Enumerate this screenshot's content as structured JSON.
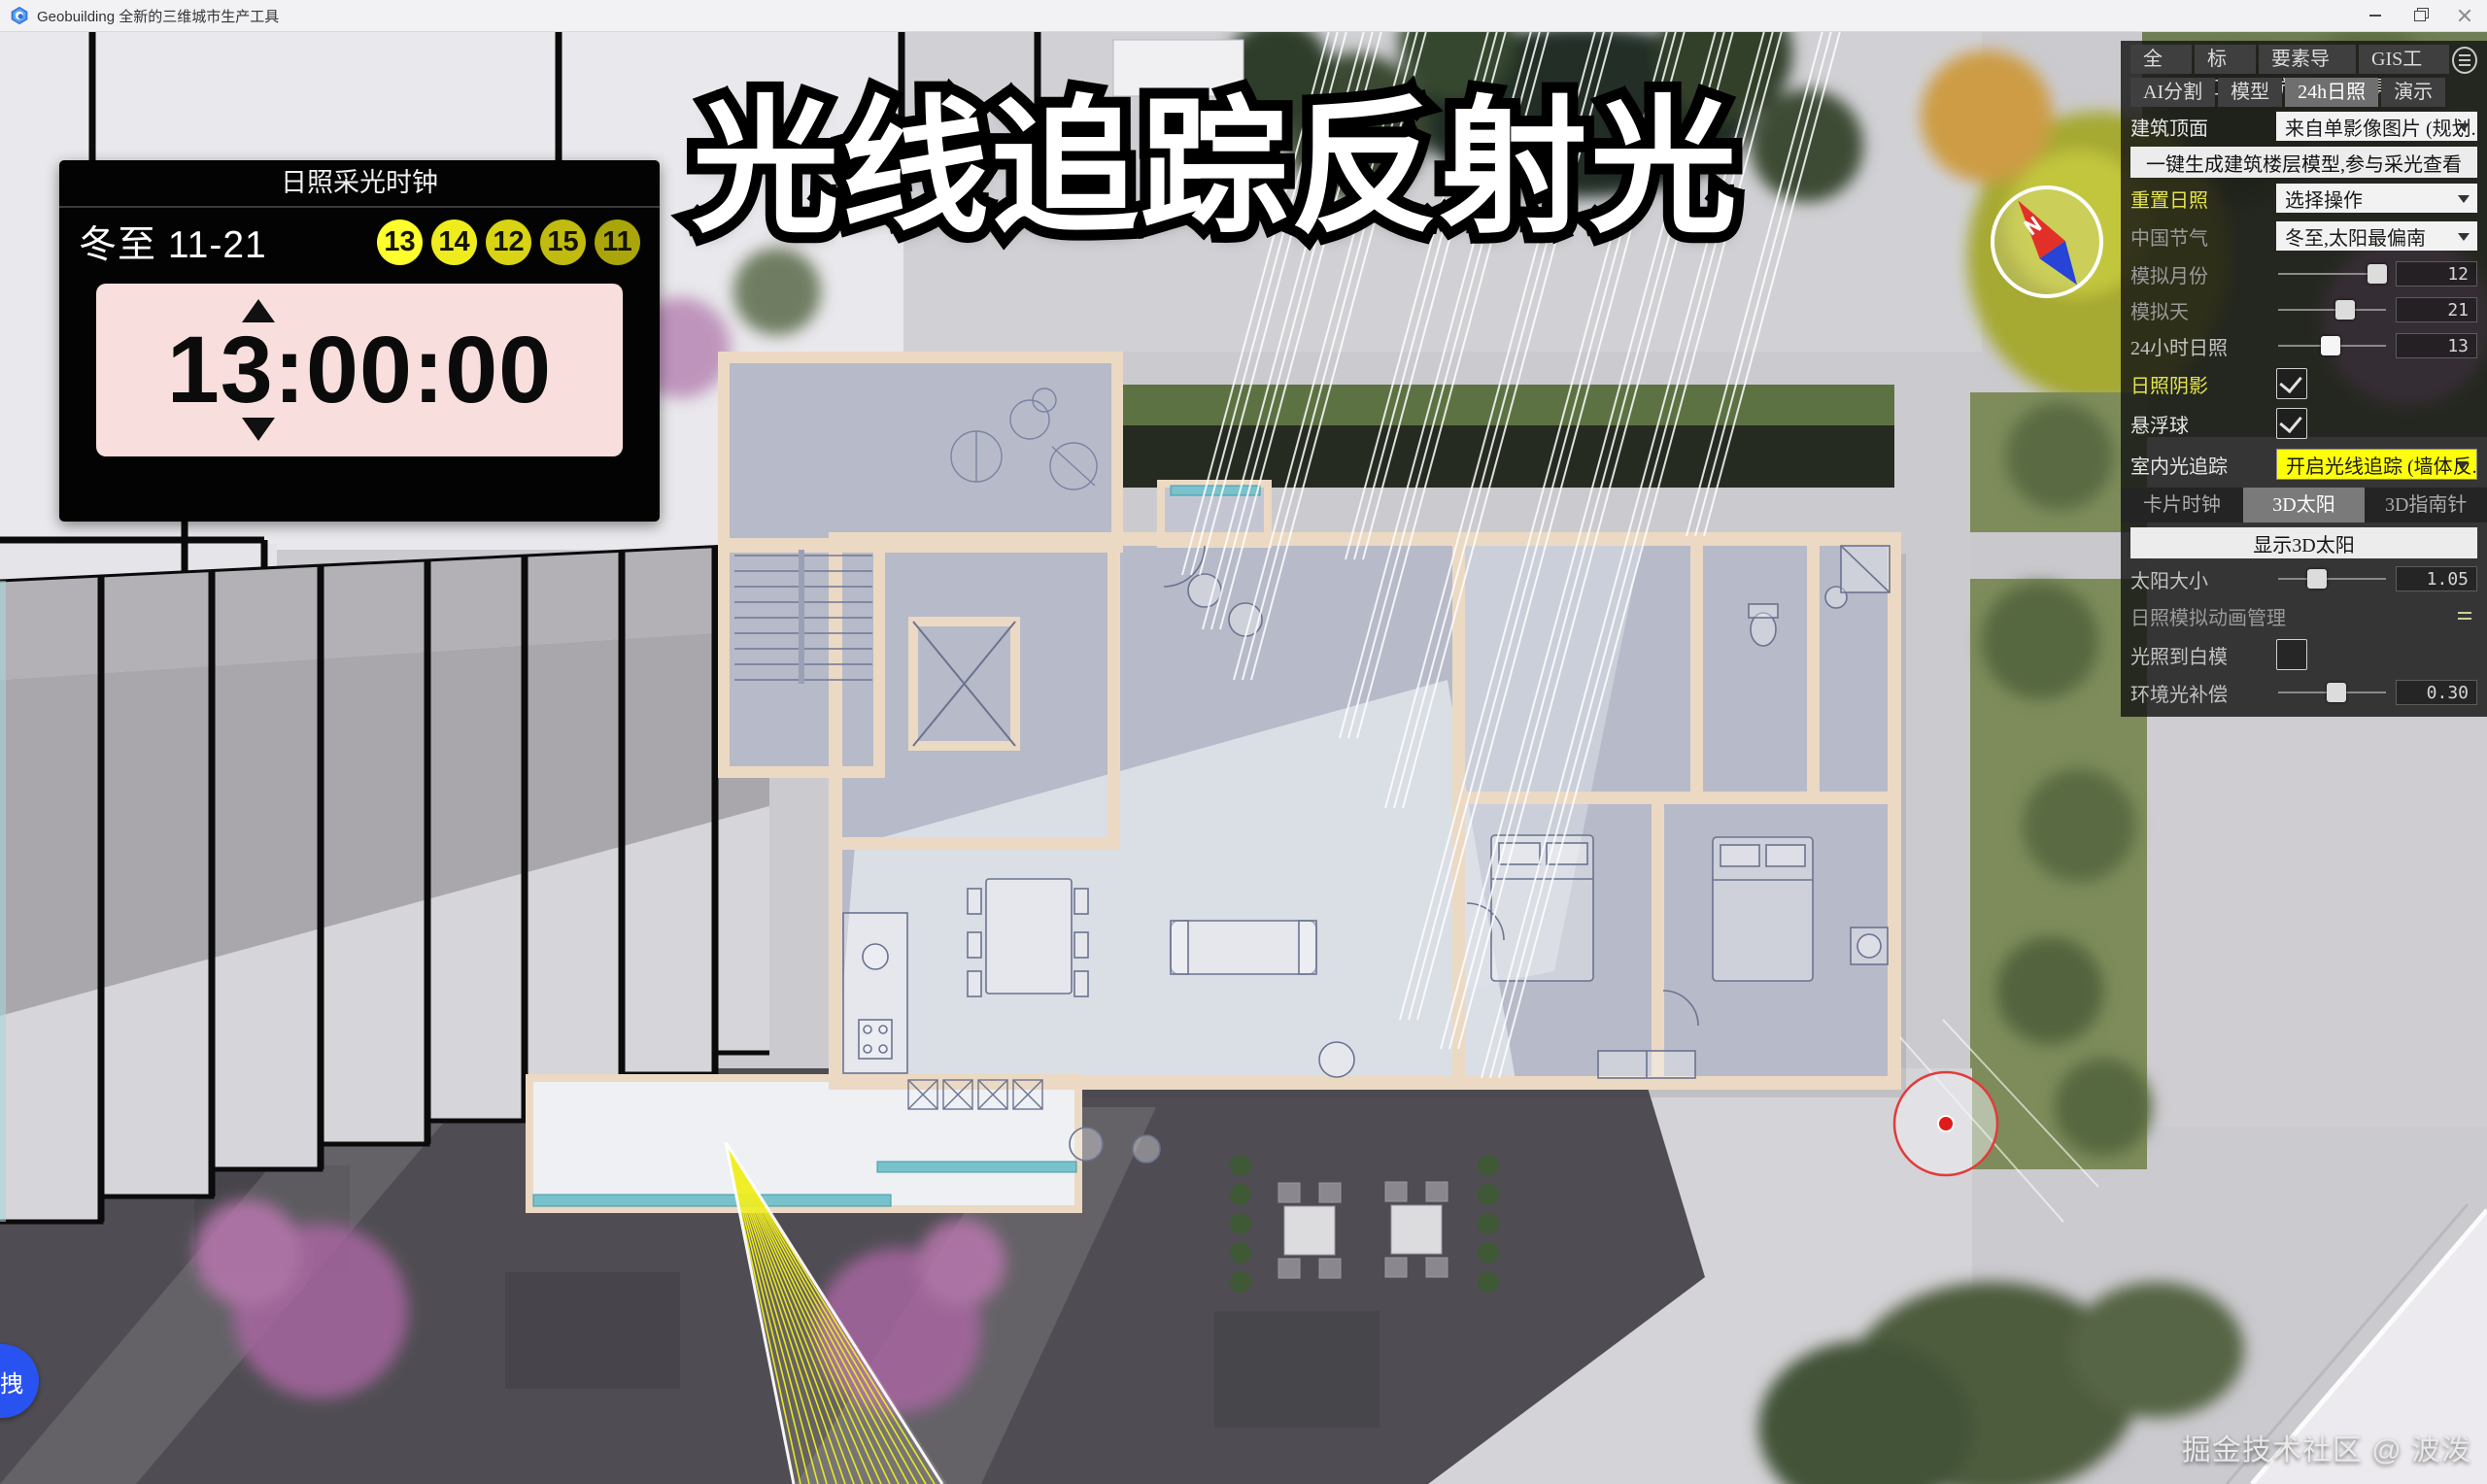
{
  "window": {
    "title": "Geobuilding 全新的三维城市生产工具"
  },
  "caption": "光线追踪反射光",
  "clock": {
    "title": "日照采光时钟",
    "solar_term": "冬至",
    "date": "11-21",
    "hour_badges": [
      "13",
      "14",
      "12",
      "15",
      "11"
    ],
    "time": "13:00:00"
  },
  "panel": {
    "tabs_row1": [
      "全局",
      "标红",
      "要素导航",
      "GIS工具"
    ],
    "tabs_row2": [
      "AI分割",
      "模型",
      "24h日照",
      "演示"
    ],
    "active_tab": "24h日照",
    "building_top": {
      "label": "建筑顶面",
      "value": "来自单影像图片 (规划..."
    },
    "generate_button": "一键生成建筑楼层模型,参与采光查看",
    "reset": {
      "label": "重置日照",
      "value": "选择操作"
    },
    "solar_term": {
      "label": "中国节气",
      "value": "冬至,太阳最偏南"
    },
    "sim_month": {
      "label": "模拟月份",
      "value": "12"
    },
    "sim_day": {
      "label": "模拟天",
      "value": "21"
    },
    "sim_hour": {
      "label": "24小时日照",
      "value": "13"
    },
    "shadow": {
      "label": "日照阴影",
      "checked": true
    },
    "float_ball": {
      "label": "悬浮球",
      "checked": true
    },
    "indoor_raytrace": {
      "label": "室内光追踪",
      "value": "开启光线追踪 (墙体反..."
    },
    "subtabs": [
      "卡片时钟",
      "3D太阳",
      "3D指南针"
    ],
    "active_subtab": "3D太阳",
    "show_sun_button": "显示3D太阳",
    "sun_size": {
      "label": "太阳大小",
      "value": "1.05"
    },
    "animation_manager": {
      "label": "日照模拟动画管理"
    },
    "light_on_white": {
      "label": "光照到白模",
      "checked": false
    },
    "ambient": {
      "label": "环境光补偿",
      "value": "0.30"
    }
  },
  "watermark": "掘金技术社区 @ 波泼",
  "drag_handle": "拽",
  "colors": {
    "badge_colors": [
      "#ffff2e",
      "#efec1e",
      "#d8d414",
      "#c0bb0e",
      "#aaa50a"
    ],
    "clock_pink": "#f8dfdd",
    "highlight_yellow": "#ffff0a",
    "ray_yellow": "#f1ee1e",
    "marker_red": "#e23b3b",
    "compass_red": "#e03028",
    "compass_blue": "#2743d8",
    "panel_active_tab_bg": "#6f6f6f",
    "reset_label_yellow": "#e3e34f"
  }
}
